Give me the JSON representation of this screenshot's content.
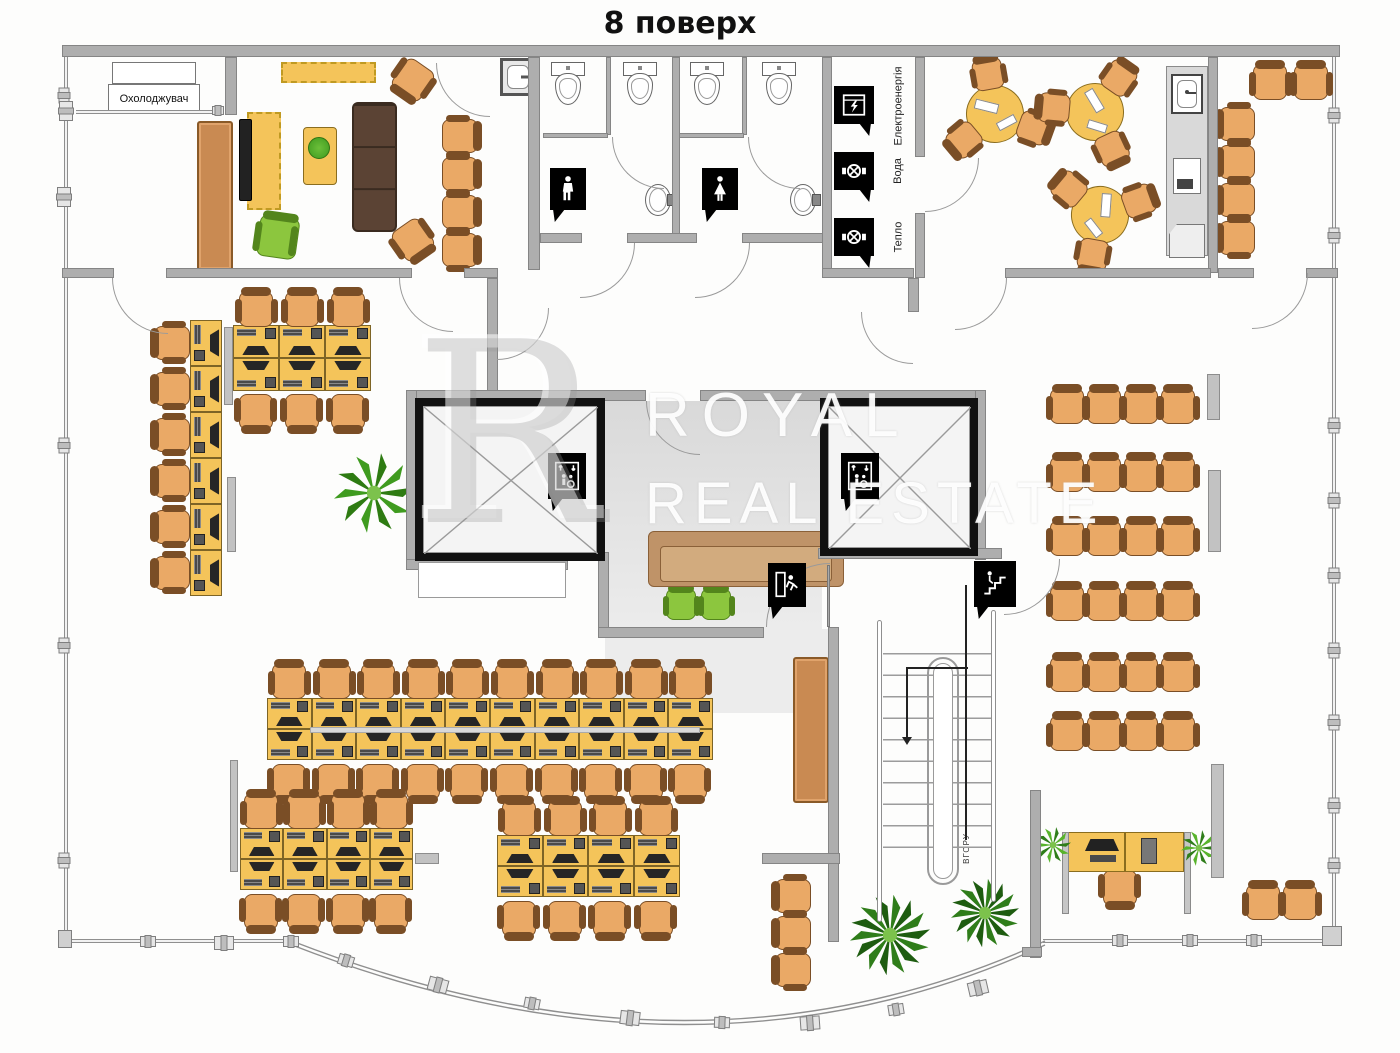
{
  "title": "8 поверх",
  "rooms": {
    "cooler_label": "Охолоджувач"
  },
  "utilities": [
    {
      "label": "Електроенергія",
      "icon": "electric-meter-icon"
    },
    {
      "label": "Вода",
      "icon": "water-valve-icon"
    },
    {
      "label": "Тепло",
      "icon": "heat-valve-icon"
    }
  ],
  "stairs": {
    "direction_label": "ВГОРУ"
  },
  "watermark": {
    "monogram": "R",
    "line1": "ROYAL",
    "line2": "REAL ESTATE"
  },
  "signs": {
    "mens_restroom": "mens-restroom-icon",
    "womens_restroom": "womens-restroom-icon",
    "elevator": "elevator-sign-icon",
    "emergency_exit": "exit-running-man-icon",
    "stairs_down": "stairs-person-icon"
  },
  "furniture_summary": {
    "open_plan_workstations": 48,
    "reception_desks": 1,
    "cafe_round_tables": 3,
    "classroom_chairs_rows": 6,
    "classroom_chairs_per_row": 4,
    "elevators": 2,
    "toilets": 4
  },
  "colors": {
    "wall": "#aeaeae",
    "wall_border": "#858585",
    "desk": "#f4c45a",
    "chair": "#eaa966",
    "chair_trim": "#7a4e26",
    "green_chair": "#8cc63e",
    "sofa_dark": "#5b4334",
    "sofa_tan": "#bf9368",
    "cabinet": "#c98a52",
    "lobby_floor": "#e2e2e2",
    "sign_bg": "#000000",
    "plant_green": "#3f9b1f",
    "palm_green": "#2f7d1a"
  }
}
